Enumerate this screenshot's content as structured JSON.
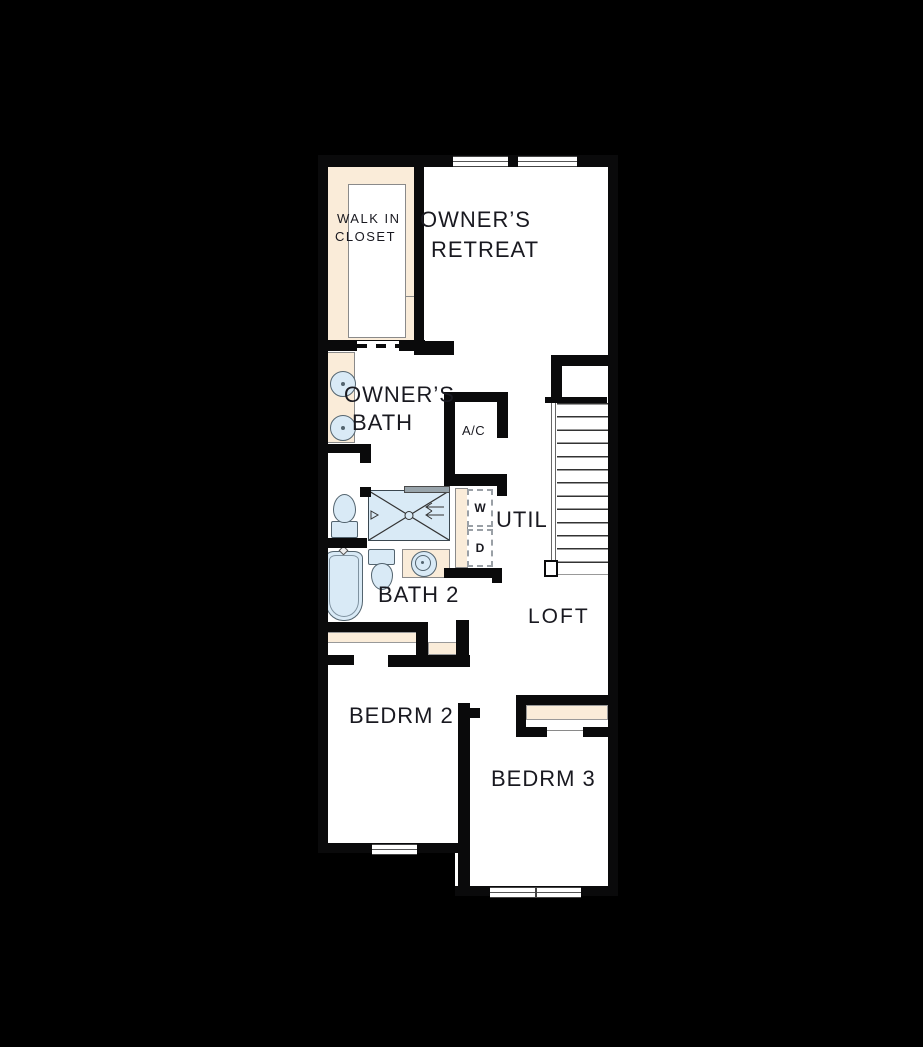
{
  "title": "Second Floor Plan",
  "colors": {
    "background": "#000000",
    "wall": "#0a0a0b",
    "floor": "#ffffff",
    "closet_fill": "#faecd9",
    "fixture_fill": "#d9eaf6",
    "fixture_line": "#53646f",
    "thin_line": "#8a8a8a",
    "label": "#191920"
  },
  "rooms": {
    "walk_in_closet": {
      "line1": "WALK IN",
      "line2": "CLOSET"
    },
    "owners_retreat": {
      "line1": "OWNER’S",
      "line2": "RETREAT"
    },
    "owners_bath": {
      "line1": "OWNER’S",
      "line2": "BATH"
    },
    "ac": {
      "label": "A/C"
    },
    "util": {
      "label": "UTIL",
      "washer": "W",
      "dryer": "D"
    },
    "bath2": {
      "label": "BATH 2"
    },
    "loft": {
      "label": "LOFT"
    },
    "bedroom2": {
      "label": "BEDRM 2"
    },
    "bedroom3": {
      "label": "BEDRM 3"
    }
  }
}
